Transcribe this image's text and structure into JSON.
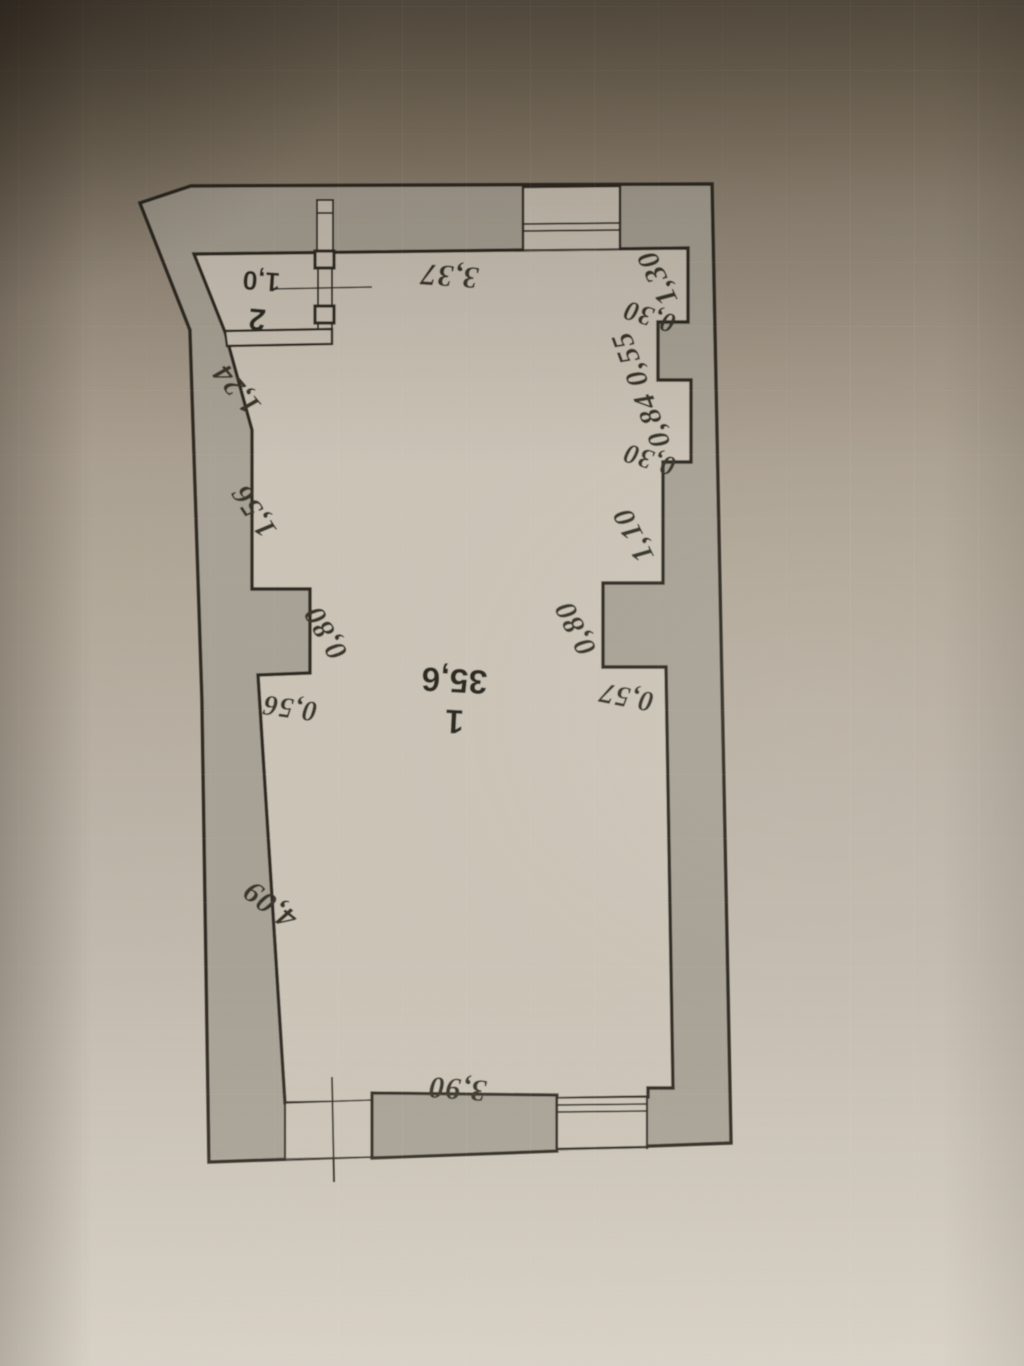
{
  "photo": {
    "scale_label": "М 1:100"
  },
  "plan": {
    "rooms": [
      {
        "number": "1",
        "area": "35,6"
      },
      {
        "number": "2",
        "area": "1,0"
      }
    ],
    "dims": {
      "top": "3,37",
      "right": [
        "1,30",
        "0,30",
        "0,55",
        "0,84",
        "0,30",
        "1,10",
        "0,80",
        "0,57"
      ],
      "left": [
        "1,24",
        "1,56",
        "0,80",
        "0,56",
        "4,09"
      ],
      "bottom": "3,90"
    }
  },
  "colors": {
    "wall_fill": "#a8a296",
    "floor_fill": "#cbc4b7",
    "ink": "#2f2b24"
  }
}
